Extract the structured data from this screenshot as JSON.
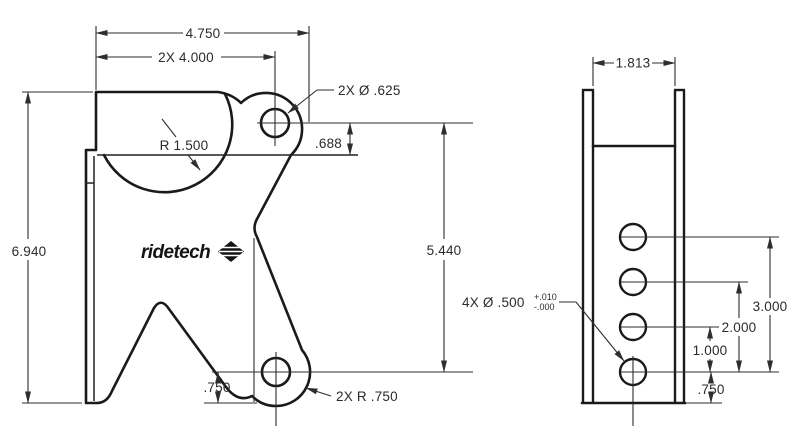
{
  "drawing": {
    "background": "#ffffff",
    "line_color": "#1a1a1a",
    "text_color": "#2b2b2b",
    "front_view": {
      "logo_text": "ridetech",
      "dims": {
        "overall_width": "4.750",
        "hole_spacing_horizontal": "2X 4.000",
        "hole_diameter_note": "2X Ø .625",
        "cutout_radius": "R 1.500",
        "flange_to_hole": ".688",
        "overall_height": "6.940",
        "hole_spacing_vertical": "5.440",
        "bottom_hole_offset": ".750",
        "lobe_radius_note": "2X R .750"
      }
    },
    "side_view": {
      "dims": {
        "inside_width": "1.813",
        "hole_diameter_note": "4X Ø .500",
        "tolerance_plus": "+.010",
        "tolerance_minus": "-.000",
        "hole_span_3": "3.000",
        "hole_span_2": "2.000",
        "hole_span_1": "1.000",
        "bottom_hole_offset": ".750"
      }
    }
  }
}
